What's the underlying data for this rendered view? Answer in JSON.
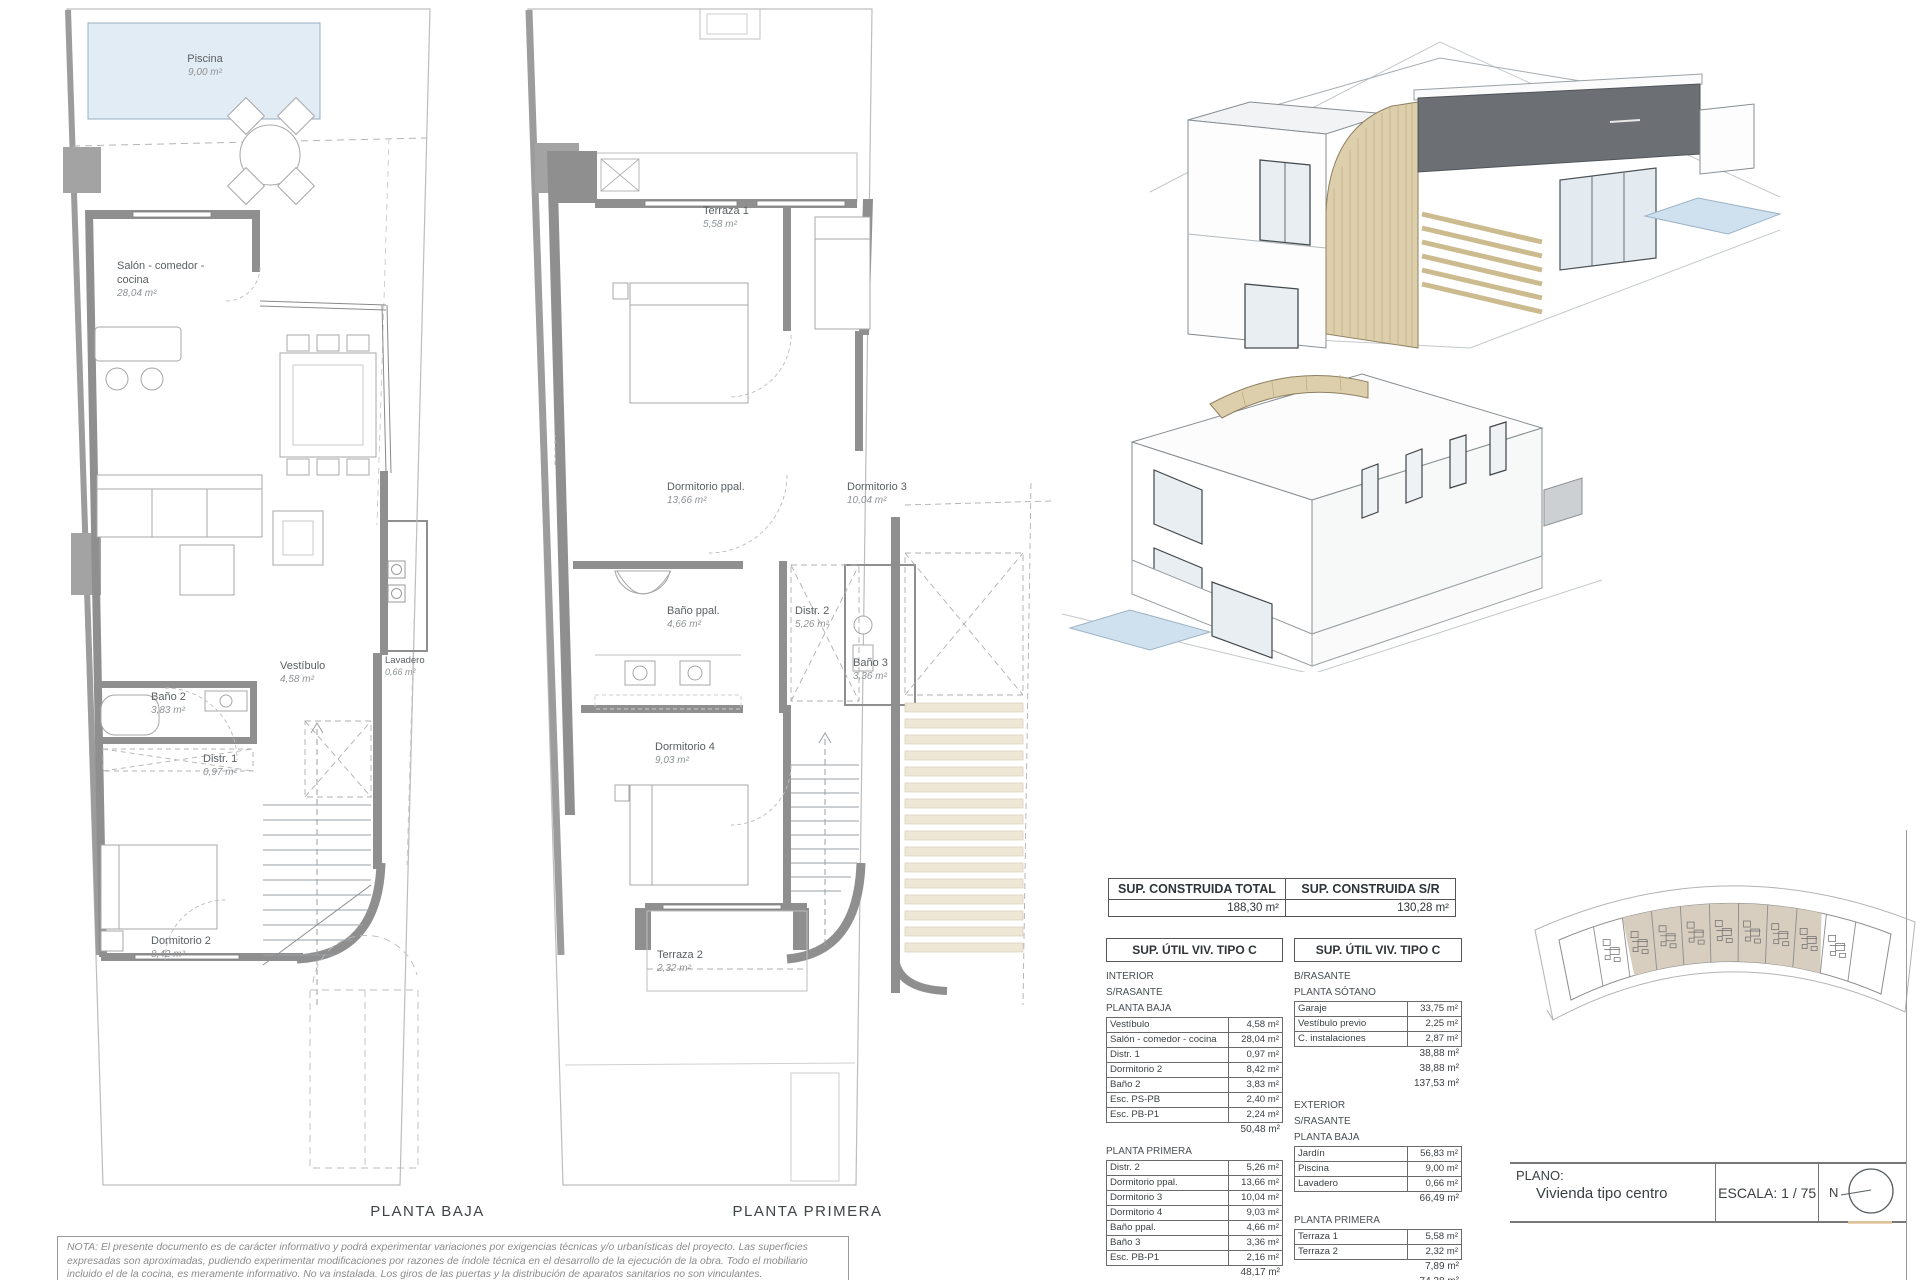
{
  "plans": {
    "planta_baja": {
      "title": "PLANTA BAJA",
      "rooms": [
        {
          "name": "Piscina",
          "area": "9,00 m²"
        },
        {
          "name": "Salón - comedor - cocina",
          "area": "28,04 m²"
        },
        {
          "name": "Vestíbulo",
          "area": "4,58 m²"
        },
        {
          "name": "Lavadero",
          "area": "0,66 m²"
        },
        {
          "name": "Baño 2",
          "area": "3,83 m²"
        },
        {
          "name": "Distr. 1",
          "area": "0,97 m²"
        },
        {
          "name": "Dormitorio 2",
          "area": "8,42 m²"
        }
      ]
    },
    "planta_primera": {
      "title": "PLANTA PRIMERA",
      "rooms": [
        {
          "name": "Terraza 1",
          "area": "5,58 m²"
        },
        {
          "name": "Dormitorio ppal.",
          "area": "13,66 m²"
        },
        {
          "name": "Dormitorio 3",
          "area": "10,04 m²"
        },
        {
          "name": "Baño ppal.",
          "area": "4,66 m²"
        },
        {
          "name": "Distr. 2",
          "area": "5,26 m²"
        },
        {
          "name": "Baño 3",
          "area": "3,36 m²"
        },
        {
          "name": "Dormitorio 4",
          "area": "9,03 m²"
        },
        {
          "name": "Terraza 2",
          "area": "2,32 m²"
        }
      ]
    }
  },
  "tables": {
    "construida": {
      "cells": [
        {
          "header": "SUP. CONSTRUIDA TOTAL",
          "value": "188,30 m²"
        },
        {
          "header": "SUP. CONSTRUIDA S/R",
          "value": "130,28 m²"
        }
      ]
    },
    "util_left": {
      "header": "SUP. ÚTIL VIV. TIPO C",
      "blocks": [
        {
          "label": "INTERIOR"
        },
        {
          "label": "S/RASANTE"
        },
        {
          "label": "PLANTA BAJA"
        },
        {
          "rows": [
            [
              "Vestíbulo",
              "4,58 m²"
            ],
            [
              "Salón - comedor - cocina",
              "28,04 m²"
            ],
            [
              "Distr. 1",
              "0,97 m²"
            ],
            [
              "Dormitorio 2",
              "8,42 m²"
            ],
            [
              "Baño 2",
              "3,83 m²"
            ],
            [
              "Esc. PS-PB",
              "2,40 m²"
            ],
            [
              "Esc. PB-P1",
              "2,24 m²"
            ]
          ]
        },
        {
          "total": "50,48 m²"
        },
        {
          "label": "PLANTA PRIMERA",
          "gap_before": 1
        },
        {
          "rows": [
            [
              "Distr. 2",
              "5,26 m²"
            ],
            [
              "Dormitorio ppal.",
              "13,66 m²"
            ],
            [
              "Dormitorio 3",
              "10,04 m²"
            ],
            [
              "Dormitorio 4",
              "9,03 m²"
            ],
            [
              "Baño ppal.",
              "4,66 m²"
            ],
            [
              "Baño 3",
              "3,36 m²"
            ],
            [
              "Esc. PB-P1",
              "2,16 m²"
            ]
          ]
        },
        {
          "total": "48,17 m²"
        },
        {
          "total": "98,65 m²"
        }
      ]
    },
    "util_right": {
      "header": "SUP. ÚTIL VIV. TIPO C",
      "blocks": [
        {
          "label": "B/RASANTE"
        },
        {
          "label": "PLANTA SÓTANO"
        },
        {
          "rows": [
            [
              "Garaje",
              "33,75 m²"
            ],
            [
              "Vestíbulo previo",
              "2,25 m²"
            ],
            [
              "C. instalaciones",
              "2,87 m²"
            ]
          ]
        },
        {
          "total": "38,88 m²"
        },
        {
          "total": "38,88 m²"
        },
        {
          "total": "137,53 m²"
        },
        {
          "label": "EXTERIOR",
          "gap_before": 1
        },
        {
          "label": "S/RASANTE"
        },
        {
          "label": "PLANTA BAJA"
        },
        {
          "rows": [
            [
              "Jardín",
              "56,83 m²"
            ],
            [
              "Piscina",
              "9,00 m²"
            ],
            [
              "Lavadero",
              "0,66 m²"
            ]
          ]
        },
        {
          "total": "66,49 m²"
        },
        {
          "label": "PLANTA PRIMERA",
          "gap_before": 1
        },
        {
          "rows": [
            [
              "Terraza 1",
              "5,58 m²"
            ],
            [
              "Terraza 2",
              "2,32 m²"
            ]
          ]
        },
        {
          "total": "7,89 m²"
        },
        {
          "total": "74,38 m²"
        }
      ]
    }
  },
  "title_block": {
    "plano_label": "PLANO:",
    "plano_value": "Vivienda tipo centro",
    "escala_label": "ESCALA:",
    "escala_value": "1 / 75",
    "north_label": "N"
  },
  "note": "NOTA: El presente documento es de carácter informativo y podrá experimentar variaciones por exigencias técnicas y/o urbanísticas del proyecto. Las superficies expresadas son aproximadas, pudiendo experimentar modificaciones por razones de índole técnica en el desarrollo de la ejecución de la obra. Todo el mobiliario incluido el de la cocina, es meramente informativo. No va instalada. Los giros de las puertas y la distribución de aparatos sanitarios no son vinculantes.",
  "site_plan": {
    "units": 9,
    "highlight_from": 1,
    "highlight_to": 7,
    "fill": "#d7cec0"
  },
  "colors": {
    "wall_gray": "#8f8f8f",
    "boundary_gray": "#9c9c9c",
    "pool_blue": "#e2ecf5",
    "pool_stroke": "#97acbf",
    "wood_tan": "#ddcfab",
    "dark_volume": "#6c7074",
    "stair_beige": "#efe7d5",
    "site_tan": "#d7cec0",
    "line": "#a7a7a7"
  }
}
